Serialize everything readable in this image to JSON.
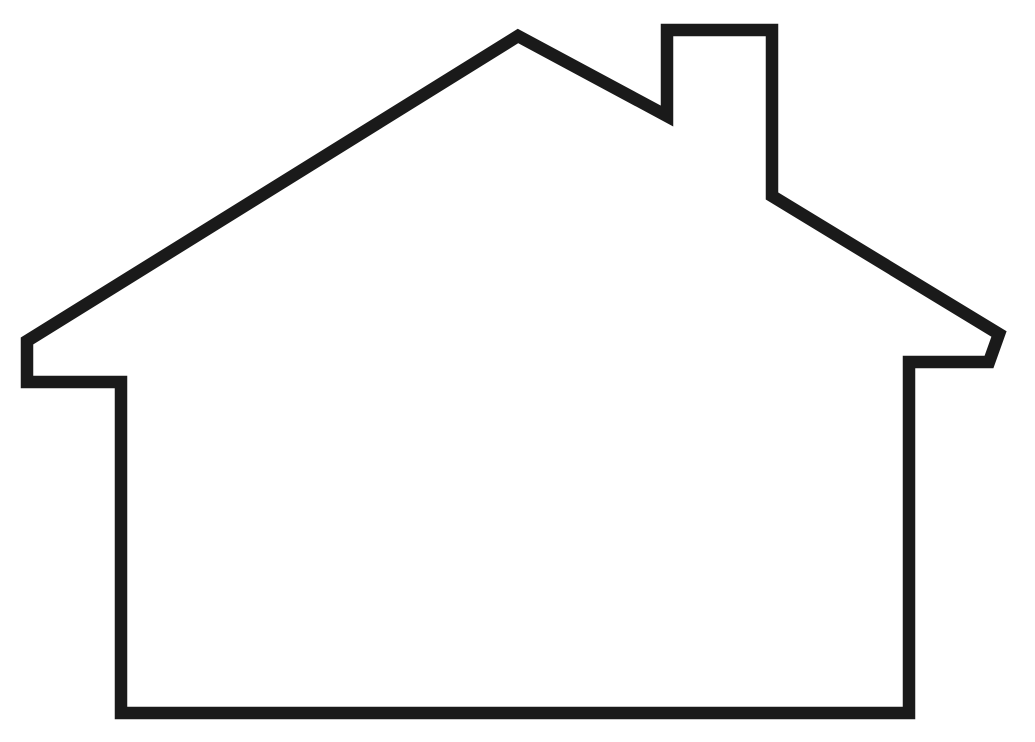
{
  "figure": {
    "description": "Black outline line drawing of a house with a chimney on a plain white background (coloring-page style clipart)",
    "background_color": "#ffffff",
    "line_color": "#1a1a1a",
    "line_width": 12.5,
    "canvas": {
      "width": 1035,
      "height": 742
    },
    "house_outline_points": "518,36 667,116 667,30 772,30 772,196 999,334 989,362 909,362 909,713 121,713 121,382 27,382 27,341"
  }
}
